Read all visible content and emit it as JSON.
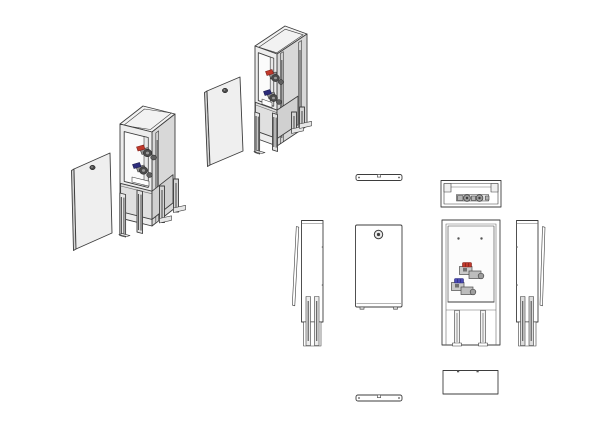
{
  "meta": {
    "drawing_style": "cad-multiview-line-drawing",
    "background": "#ffffff"
  },
  "subject": {
    "name": "free-standing-valve-cabinet-with-removable-door",
    "views": {
      "iso_a": "isometric-exploded-view-front-left-door-removed",
      "iso_b": "isometric-exploded-view-front-right-door-removed",
      "top_door": "top-view-door-panel",
      "top_cabinet": "top-view-cabinet-with-valve-manifold",
      "side_left": "left-side-view-cabinet-and-door-edge",
      "front_door": "front-view-door-panel-with-lock",
      "front_cabinet": "front-view-open-cabinet-with-valves",
      "side_right": "right-side-view-cabinet-and-door-edge",
      "bottom_cabinet": "bottom-view-cabinet",
      "bottom_door": "bottom-view-door-panel"
    }
  },
  "colors": {
    "line": "#3d3d3d",
    "face_top": "#f2f2f2",
    "face_front": "#ededed",
    "face_side": "#d8d8d8",
    "face_door": "#efefef",
    "door_edge": "#d5d5d5",
    "interior": "#fbfbfb",
    "interior_wall": "#e8e8e8",
    "band": "#e0e0e0",
    "band_side": "#d0d0d0",
    "channel": "#cfcfcf",
    "leg_fill": "#e9e9e9",
    "leg_back": "#d4d4d4",
    "slot_dark": "#555555",
    "valve_red": "#c0392b",
    "valve_red_dark": "#7e1f1a",
    "valve_blue": "#4a4ab4",
    "valve_blue_dark": "#2c2c7a",
    "valve_body": "#4a4a4a",
    "valve_body_mid": "#5f5f5f",
    "valve_body_light": "#8f8f8f",
    "metal_light": "#b5b5b5",
    "lock_dark": "#4a4a4a",
    "white": "#ffffff"
  }
}
